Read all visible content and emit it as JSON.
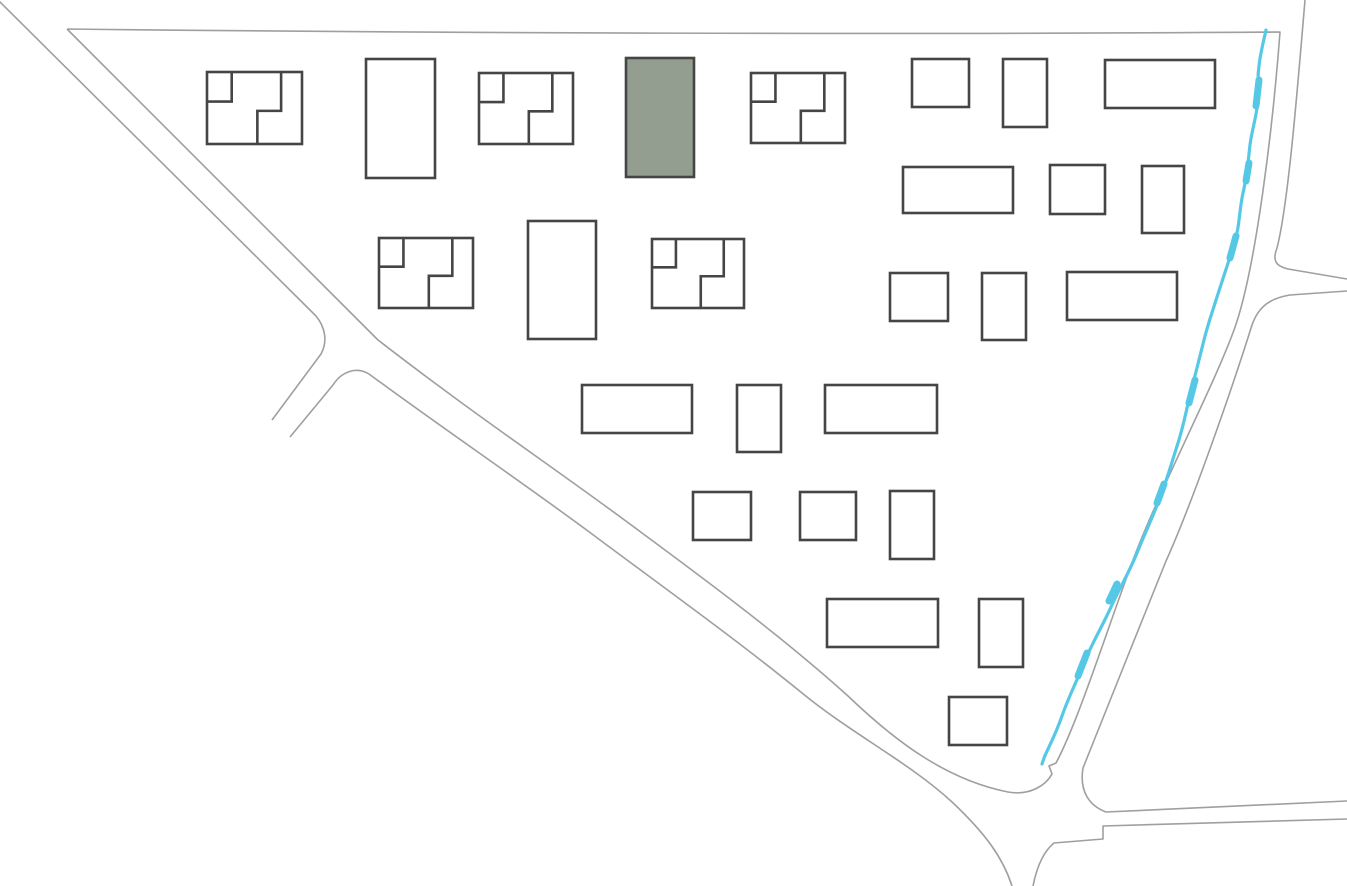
{
  "map": {
    "canvas": {
      "width": 1347,
      "height": 886,
      "background": "#ffffff"
    },
    "colors": {
      "road": "#9f9f9f",
      "building_stroke": "#454545",
      "building_fill": "#ffffff",
      "highlight_fill": "#949e90",
      "river": "#55c8e6"
    },
    "strokes": {
      "road_width": 1.6,
      "building_width": 2.6,
      "river_width": 3.2,
      "river_blob_width": 7
    },
    "roads": [
      {
        "name": "block-boundary-top-vertical-and-main-road-inner-edge",
        "d": "M 67 29 C 420 33, 900 35, 1280 32 C 1273 125, 1256 270, 1234 330 C 1212 390, 1161 486, 1133 560 C 1107 630, 1078 722, 1056 763 L 1049 766 L 1052 774 C 1046 785, 1030 796, 1008 792 C 947 780, 896 742, 848 696 C 788 642, 722 592, 642 533 C 562 473, 480 419, 378 340 L 67 29"
      },
      {
        "name": "main-road-outer-edge-upper",
        "d": "M -4 -2 L 316 316 C 325 327, 328 341, 321 354 L 272 420"
      },
      {
        "name": "spur-south-edge-and-main-road-outer-edge",
        "d": "M 290 437 L 333 385 C 341 372, 356 366, 369 374 C 445 430, 522 482, 592 534 C 667 590, 737 640, 802 693 C 852 734, 910 763, 952 802 C 986 834, 1003 858, 1012 886"
      },
      {
        "name": "south-road-east-edge-and-east-road-south-edge",
        "d": "M 1033 886 C 1037 866, 1044 851, 1054 843 L 1103 839 L 1103 826 L 1347 819"
      },
      {
        "name": "vertical-road-east-edge-upper-and-ne-branch-north-edge",
        "d": "M 1305 0 C 1297 95, 1288 205, 1277 248 C 1272 261, 1276 266, 1288 269 L 1347 279"
      },
      {
        "name": "ne-branch-south-edge-vertical-east-edge-and-east-road-north-edge",
        "d": "M 1347 291 L 1290 295 C 1272 298, 1259 305, 1252 325 C 1231 392, 1191 506, 1166 561 C 1142 620, 1104 716, 1083 768 C 1079 792, 1090 806, 1106 812 L 1347 801"
      }
    ],
    "river": {
      "main": "M 1266 30 C 1261 52, 1257 68, 1258 90 C 1259 110, 1252 128, 1250 145 C 1248 162, 1247 176, 1243 193 C 1239 211, 1240 226, 1234 244 C 1228 264, 1223 278, 1217 297 C 1211 316, 1208 324, 1204 340 C 1199 360, 1196 372, 1191 391 C 1186 411, 1184 424, 1178 443 C 1171 465, 1167 479, 1160 498 C 1151 521, 1145 533, 1137 553 C 1127 577, 1119 589, 1111 607 C 1101 629, 1093 641, 1085 661 C 1076 683, 1069 696, 1062 716 C 1055 736, 1049 746, 1044 758 L 1042 764",
      "blobs": [
        "M 1259 80 L 1256 106",
        "M 1249 163 L 1246 181",
        "M 1236 236 L 1230 258",
        "M 1195 380 L 1189 403",
        "M 1164 484 L 1157 503",
        "M 1117 584 L 1109 601",
        "M 1087 653 L 1078 676"
      ]
    },
    "subdivision_pattern": {
      "corner_square_x": 0.26,
      "corner_square_y": 0.41,
      "step_x1": 0.78,
      "step_y": 0.54,
      "step_x2": 0.53
    },
    "buildings": [
      {
        "id": "b01",
        "kind": "subdivided",
        "x": 207,
        "y": 72,
        "w": 95,
        "h": 72
      },
      {
        "id": "b02",
        "kind": "plain",
        "x": 366,
        "y": 59,
        "w": 69,
        "h": 119
      },
      {
        "id": "b03",
        "kind": "subdivided",
        "x": 479,
        "y": 73,
        "w": 94,
        "h": 71
      },
      {
        "id": "b04",
        "kind": "highlighted",
        "x": 626,
        "y": 58,
        "w": 68,
        "h": 119
      },
      {
        "id": "b05",
        "kind": "subdivided",
        "x": 751,
        "y": 73,
        "w": 94,
        "h": 70
      },
      {
        "id": "b06",
        "kind": "plain",
        "x": 912,
        "y": 59,
        "w": 57,
        "h": 48
      },
      {
        "id": "b07",
        "kind": "plain",
        "x": 1003,
        "y": 59,
        "w": 44,
        "h": 68
      },
      {
        "id": "b08",
        "kind": "plain",
        "x": 1105,
        "y": 60,
        "w": 110,
        "h": 48
      },
      {
        "id": "b09",
        "kind": "plain",
        "x": 903,
        "y": 167,
        "w": 110,
        "h": 46
      },
      {
        "id": "b10",
        "kind": "plain",
        "x": 1050,
        "y": 165,
        "w": 55,
        "h": 49
      },
      {
        "id": "b11",
        "kind": "plain",
        "x": 1142,
        "y": 166,
        "w": 42,
        "h": 67
      },
      {
        "id": "b12",
        "kind": "subdivided",
        "x": 379,
        "y": 238,
        "w": 94,
        "h": 70
      },
      {
        "id": "b13",
        "kind": "plain",
        "x": 528,
        "y": 221,
        "w": 68,
        "h": 118
      },
      {
        "id": "b14",
        "kind": "subdivided",
        "x": 652,
        "y": 239,
        "w": 92,
        "h": 69
      },
      {
        "id": "b15",
        "kind": "plain",
        "x": 890,
        "y": 273,
        "w": 58,
        "h": 48
      },
      {
        "id": "b16",
        "kind": "plain",
        "x": 982,
        "y": 273,
        "w": 44,
        "h": 67
      },
      {
        "id": "b17",
        "kind": "plain",
        "x": 1067,
        "y": 272,
        "w": 110,
        "h": 48
      },
      {
        "id": "b18",
        "kind": "plain",
        "x": 582,
        "y": 385,
        "w": 110,
        "h": 48
      },
      {
        "id": "b19",
        "kind": "plain",
        "x": 737,
        "y": 385,
        "w": 44,
        "h": 67
      },
      {
        "id": "b20",
        "kind": "plain",
        "x": 825,
        "y": 385,
        "w": 112,
        "h": 48
      },
      {
        "id": "b21",
        "kind": "plain",
        "x": 693,
        "y": 492,
        "w": 58,
        "h": 48
      },
      {
        "id": "b22",
        "kind": "plain",
        "x": 800,
        "y": 492,
        "w": 56,
        "h": 48
      },
      {
        "id": "b23",
        "kind": "plain",
        "x": 890,
        "y": 491,
        "w": 44,
        "h": 68
      },
      {
        "id": "b24",
        "kind": "plain",
        "x": 827,
        "y": 599,
        "w": 111,
        "h": 48
      },
      {
        "id": "b25",
        "kind": "plain",
        "x": 979,
        "y": 599,
        "w": 44,
        "h": 68
      },
      {
        "id": "b26",
        "kind": "plain",
        "x": 949,
        "y": 697,
        "w": 58,
        "h": 48
      }
    ]
  }
}
